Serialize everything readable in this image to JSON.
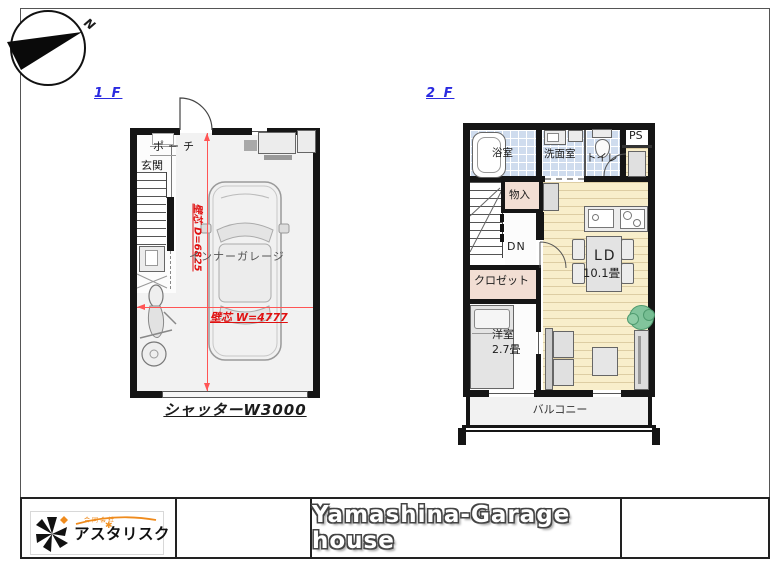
{
  "compass": {
    "north": "N"
  },
  "floor1": {
    "label": "1 F",
    "rooms": {
      "porch": "ポーチ",
      "entrance": "玄関",
      "garage": "インナーガレージ"
    },
    "dimensions": {
      "depth": "壁芯 D=6825",
      "width": "壁芯 W=4777"
    },
    "shutter": "シャッターW3000"
  },
  "floor2": {
    "label": "2 F",
    "rooms": {
      "bathroom": "浴室",
      "washroom": "洗面室",
      "toilet": "トイレ",
      "pipe_space": "PS",
      "storage": "物入",
      "stairs_down": "DN",
      "closet": "クロゼット",
      "living_dining": "LD",
      "living_dining_size": "10.1畳",
      "western_room": "洋室",
      "western_room_size": "2.7畳",
      "balcony": "バルコニー"
    }
  },
  "title_block": {
    "project_title": "Yamashina-Garage house",
    "company_type": "合同会社",
    "company_name": "アスタリスク"
  },
  "icons": {
    "logo_star_accent": "✱"
  },
  "colors": {
    "floor_label_blue": "#2a2ae0",
    "dimension_red": "#e01010",
    "wood_floor": "#f8eecb",
    "tile_blue": "#cfdcee",
    "room_pink": "#f2ded3",
    "wall_black": "#151515",
    "logo_orange": "#ef8b1d"
  }
}
